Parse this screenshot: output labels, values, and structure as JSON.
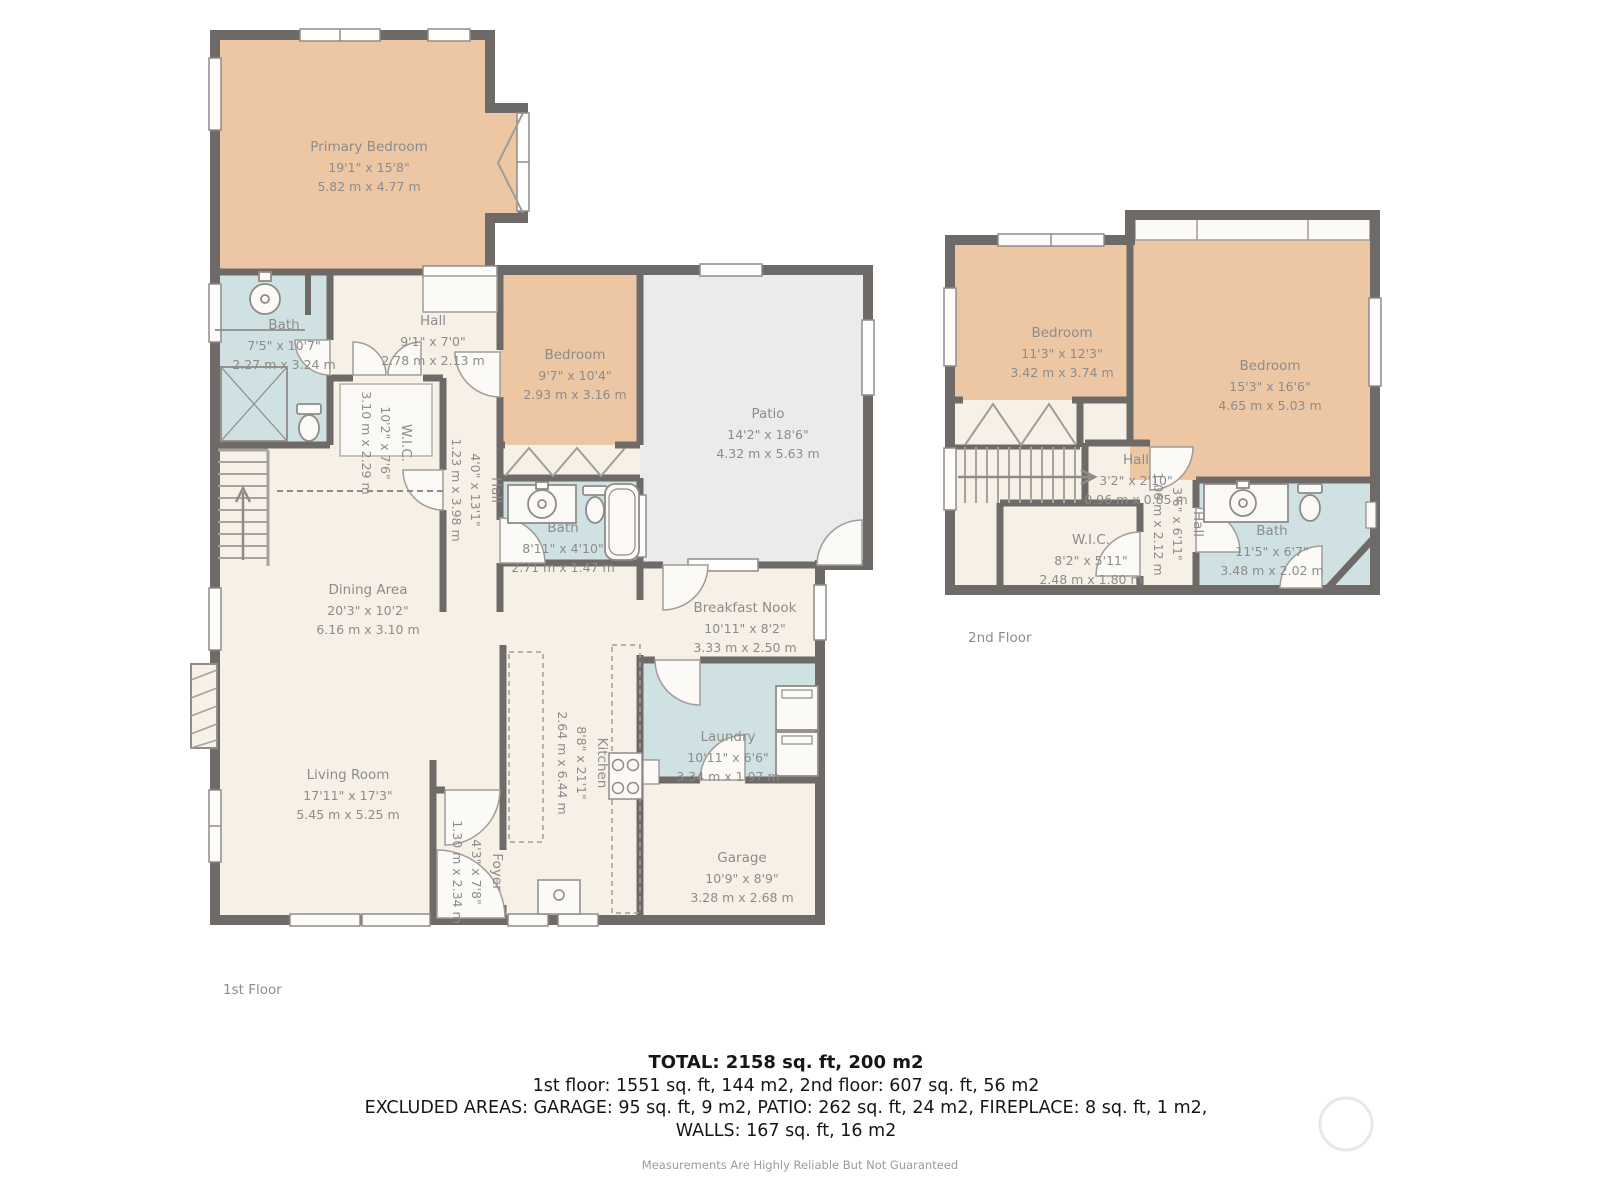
{
  "colors": {
    "wall": "#6e6a67",
    "bedroom_fill": "#edc7a4",
    "room_fill": "#f7f0e7",
    "bath_fill": "#cfe1e3",
    "patio_fill": "#ebebeb",
    "label_text": "#8c8c8c"
  },
  "floors": [
    {
      "caption": "1st Floor",
      "rooms": [
        {
          "name": "Primary Bedroom",
          "ft": "19'1\" x 15'8\"",
          "m": "5.82 m x 4.77 m"
        },
        {
          "name": "Bath",
          "ft": "7'5\" x 10'7\"",
          "m": "2.27 m x 3.24 m"
        },
        {
          "name": "Hall",
          "ft": "9'1\" x 7'0\"",
          "m": "2.78 m x 2.13 m"
        },
        {
          "name": "W.I.C.",
          "ft": "10'2\" x 7'6\"",
          "m": "3.10 m x 2.29 m"
        },
        {
          "name": "Hall",
          "ft": "4'0\" x 13'1\"",
          "m": "1.23 m x 3.98 m"
        },
        {
          "name": "Bedroom",
          "ft": "9'7\" x 10'4\"",
          "m": "2.93 m x 3.16 m"
        },
        {
          "name": "Patio",
          "ft": "14'2\" x 18'6\"",
          "m": "4.32 m x 5.63 m"
        },
        {
          "name": "Bath",
          "ft": "8'11\" x 4'10\"",
          "m": "2.71 m x 1.47 m"
        },
        {
          "name": "Dining Area",
          "ft": "20'3\" x 10'2\"",
          "m": "6.16 m x 3.10 m"
        },
        {
          "name": "Breakfast Nook",
          "ft": "10'11\" x 8'2\"",
          "m": "3.33 m x 2.50 m"
        },
        {
          "name": "Living Room",
          "ft": "17'11\" x 17'3\"",
          "m": "5.45 m x 5.25 m"
        },
        {
          "name": "Kitchen",
          "ft": "8'8\" x 21'1\"",
          "m": "2.64 m x 6.44 m"
        },
        {
          "name": "Laundry",
          "ft": "10'11\" x 6'6\"",
          "m": "3.34 m x 1.97 m"
        },
        {
          "name": "Foyer",
          "ft": "4'3\" x 7'8\"",
          "m": "1.30 m x 2.34 m"
        },
        {
          "name": "Garage",
          "ft": "10'9\" x 8'9\"",
          "m": "3.28 m x 2.68 m"
        }
      ]
    },
    {
      "caption": "2nd Floor",
      "rooms": [
        {
          "name": "Bedroom",
          "ft": "11'3\" x 12'3\"",
          "m": "3.42 m x 3.74 m"
        },
        {
          "name": "Bedroom",
          "ft": "15'3\" x 16'6\"",
          "m": "4.65 m x 5.03 m"
        },
        {
          "name": "Hall",
          "ft": "3'2\" x 2'10\"",
          "m": "0.96 m x 0.85 m"
        },
        {
          "name": "W.I.C.",
          "ft": "8'2\" x 5'11\"",
          "m": "2.48 m x 1.80 m"
        },
        {
          "name": "Hall",
          "ft": "3'6\" x 6'11\"",
          "m": "1.06 m x 2.12 m"
        },
        {
          "name": "Bath",
          "ft": "11'5\" x 6'7\"",
          "m": "3.48 m x 2.02 m"
        }
      ]
    }
  ],
  "summary": {
    "total": "TOTAL: 2158 sq. ft, 200 m2",
    "floors_line": "1st floor: 1551 sq. ft, 144 m2, 2nd floor: 607 sq. ft, 56 m2",
    "excluded_line1": "EXCLUDED AREAS: GARAGE: 95 sq. ft, 9 m2, PATIO: 262 sq. ft, 24 m2, FIREPLACE: 8 sq. ft, 1 m2,",
    "excluded_line2": "WALLS: 167 sq. ft, 16 m2",
    "disclaimer": "Measurements Are Highly Reliable But Not Guaranteed"
  }
}
